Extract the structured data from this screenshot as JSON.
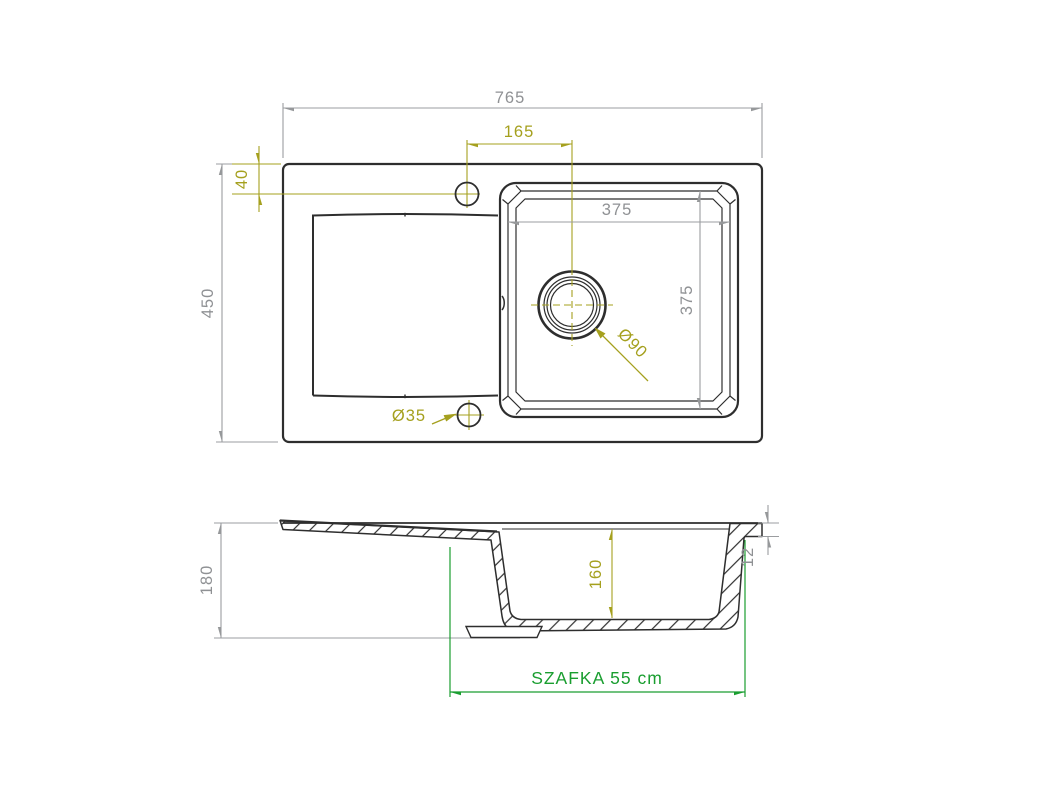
{
  "drawing": {
    "type": "sink-technical-drawing",
    "colors": {
      "outline": "#2e2e2e",
      "dim_gray": "#96989a",
      "dim_olive": "#a5a01e",
      "dim_green": "#1a9e30"
    },
    "top_view": {
      "dims": {
        "overall_width": "765",
        "overall_depth": "450",
        "faucet_to_drain_offset": "165",
        "faucet_edge_offset": "40",
        "bowl_width": "375",
        "bowl_depth": "375",
        "drain_diameter": "Ø90",
        "accessory_hole_diameter": "Ø35"
      }
    },
    "section_view": {
      "dims": {
        "total_height": "180",
        "bowl_inner_depth": "160",
        "rim_height": "12",
        "cabinet_note": "SZAFKA 55 cm"
      }
    }
  }
}
